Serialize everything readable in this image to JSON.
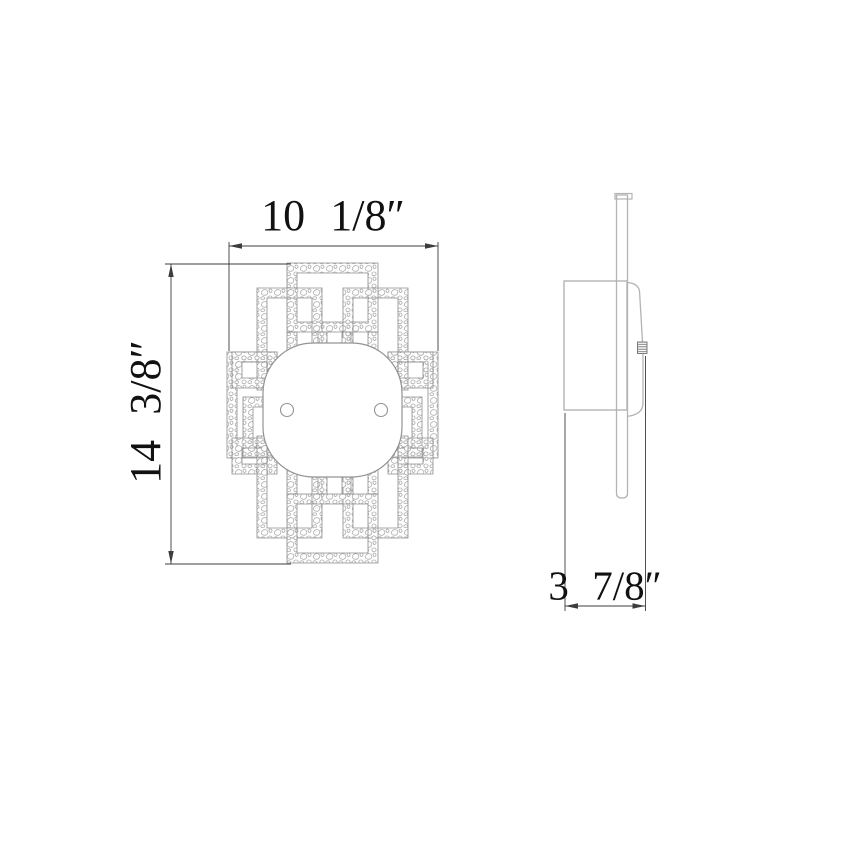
{
  "page": {
    "title": "Wall sconce dimensional drawing",
    "background": "#ffffff"
  },
  "dimensions": {
    "width_label": "10 1/8″",
    "height_label": "14 3/8″",
    "depth_label": "3 7/8″"
  },
  "style": {
    "dim_color": "#3c3c3c",
    "text_color": "#111111",
    "lattice_stroke": "#8c8c8c",
    "pebble_stroke": "#a6a6a6",
    "diffuser_stroke": "#939393",
    "side_stroke": "#b3b3b3",
    "knob_stroke": "#6f6f6f"
  },
  "drawing": {
    "front": {
      "frames": [
        {
          "name": "lattice-frame-top-center",
          "rect": [
            287,
            263,
            378,
            332
          ]
        },
        {
          "name": "lattice-frame-upper-left",
          "rect": [
            257,
            288,
            322,
            390
          ]
        },
        {
          "name": "lattice-frame-upper-right",
          "rect": [
            343,
            288,
            408,
            390
          ]
        },
        {
          "name": "lattice-frame-far-left",
          "rect": [
            227,
            352,
            277,
            458
          ]
        },
        {
          "name": "lattice-frame-far-right",
          "rect": [
            388,
            352,
            438,
            458
          ]
        },
        {
          "name": "lattice-frame-mid-left-small",
          "rect": [
            232,
            352,
            277,
            388
          ]
        },
        {
          "name": "lattice-frame-mid-right-small",
          "rect": [
            388,
            352,
            433,
            388
          ]
        },
        {
          "name": "lattice-frame-center-left",
          "rect": [
            243,
            397,
            318,
            457
          ]
        },
        {
          "name": "lattice-frame-center-right",
          "rect": [
            347,
            397,
            422,
            457
          ]
        },
        {
          "name": "lattice-frame-lower-left-small",
          "rect": [
            232,
            438,
            277,
            474
          ]
        },
        {
          "name": "lattice-frame-lower-right-small",
          "rect": [
            388,
            438,
            433,
            474
          ]
        },
        {
          "name": "lattice-frame-lower-left",
          "rect": [
            257,
            436,
            322,
            538
          ]
        },
        {
          "name": "lattice-frame-lower-right",
          "rect": [
            343,
            436,
            408,
            538
          ]
        },
        {
          "name": "lattice-frame-bottom-center",
          "rect": [
            287,
            494,
            378,
            563
          ]
        }
      ],
      "bars": [
        {
          "name": "lattice-bar",
          "x": 287,
          "y": 332,
          "w": 10,
          "h": 22
        },
        {
          "name": "lattice-bar",
          "x": 368,
          "y": 332,
          "w": 10,
          "h": 22
        },
        {
          "name": "lattice-bar",
          "x": 318,
          "y": 332,
          "w": 9,
          "h": 22
        },
        {
          "name": "lattice-bar",
          "x": 342,
          "y": 332,
          "w": 9,
          "h": 22
        },
        {
          "name": "lattice-bar",
          "x": 287,
          "y": 466,
          "w": 10,
          "h": 28
        },
        {
          "name": "lattice-bar",
          "x": 368,
          "y": 466,
          "w": 10,
          "h": 28
        },
        {
          "name": "lattice-bar",
          "x": 318,
          "y": 468,
          "w": 9,
          "h": 26
        },
        {
          "name": "lattice-bar",
          "x": 342,
          "y": 468,
          "w": 9,
          "h": 26
        }
      ],
      "diffuser": {
        "name": "diffuser-panel",
        "x": 263,
        "y": 343,
        "w": 139,
        "h": 134,
        "rx": 50
      },
      "screws": [
        {
          "name": "screw-circle-left",
          "cx": 287,
          "cy": 410,
          "r": 6.5
        },
        {
          "name": "screw-circle-right",
          "cx": 381,
          "cy": 410,
          "r": 6.5
        }
      ]
    },
    "side": {
      "backplate": {
        "name": "backplate",
        "x": 564,
        "y": 281,
        "w": 63,
        "h": 129
      },
      "strip_path": {
        "name": "mounting-strip",
        "d": "M616.5,195 H627.5 V493.5 Q627.5,498 622,498 Q616.5,498 616.5,493.5 Z"
      },
      "flange": {
        "name": "strip-top-flange",
        "x": 615,
        "y": 193.5,
        "w": 17,
        "h": 5.5
      },
      "profiles": [
        {
          "name": "diffuser-profile-upper",
          "d": "M628,282.5 Q638,283.5 639.5,291 L642.5,341.5"
        },
        {
          "name": "diffuser-profile-lower",
          "d": "M643,353.5 L643,403 Q643,412.5 632,415.5 Q629.5,416.2 628,416.2"
        }
      ],
      "knob": {
        "name": "screw-knob",
        "x": 637.5,
        "y": 342,
        "w": 9.5,
        "h": 11.5
      }
    },
    "dims": {
      "ext_lines": [
        {
          "name": "width-ext-line-left",
          "x1": 229,
          "y1": 242,
          "x2": 229,
          "y2": 351
        },
        {
          "name": "width-ext-line-right",
          "x1": 438,
          "y1": 242,
          "x2": 438,
          "y2": 351
        },
        {
          "name": "height-ext-line-top",
          "x1": 165,
          "y1": 264,
          "x2": 291,
          "y2": 264
        },
        {
          "name": "height-ext-line-bottom",
          "x1": 165,
          "y1": 564,
          "x2": 291,
          "y2": 564
        },
        {
          "name": "depth-ext-line-left",
          "x1": 565,
          "y1": 413,
          "x2": 565,
          "y2": 611
        },
        {
          "name": "depth-ext-line-right",
          "x1": 645.5,
          "y1": 356,
          "x2": 645.5,
          "y2": 611
        }
      ],
      "dim_lines": [
        {
          "name": "width-dimension-line",
          "x1": 229,
          "y1": 246,
          "x2": 438,
          "y2": 246
        },
        {
          "name": "height-dimension-line",
          "x1": 171,
          "y1": 264,
          "x2": 171,
          "y2": 564
        },
        {
          "name": "depth-dimension-line",
          "x1": 565,
          "y1": 606,
          "x2": 645.5,
          "y2": 606
        }
      ],
      "arrows": [
        {
          "name": "arrowhead",
          "x": 229,
          "y": 246,
          "dir": "left"
        },
        {
          "name": "arrowhead",
          "x": 438,
          "y": 246,
          "dir": "right"
        },
        {
          "name": "arrowhead",
          "x": 171,
          "y": 264,
          "dir": "up"
        },
        {
          "name": "arrowhead",
          "x": 171,
          "y": 564,
          "dir": "down"
        },
        {
          "name": "arrowhead",
          "x": 565,
          "y": 606,
          "dir": "left"
        },
        {
          "name": "arrowhead",
          "x": 645.5,
          "y": 606,
          "dir": "right"
        }
      ]
    }
  },
  "labels": {
    "width": {
      "x": 333,
      "y": 216
    },
    "height": {
      "x": 146,
      "y": 412
    },
    "depth": {
      "x": 605,
      "y": 586
    }
  }
}
